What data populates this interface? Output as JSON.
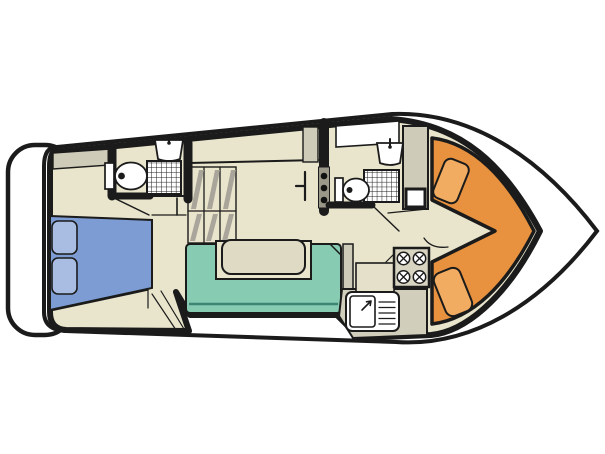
{
  "diagram": {
    "type": "boat-floor-plan",
    "description": "Top-down deck plan of a motor cruiser, bow to the right, stern with swim platform to the left",
    "orientation": {
      "bow": "right",
      "stern": "left"
    },
    "colors": {
      "background": "#ffffff",
      "outline": "#1b1b1b",
      "hull_white": "#ffffff",
      "floor": "#e9e5cc",
      "furniture_gray": "#cfcbb9",
      "counter_slab_gray": "#d2cebc",
      "worktop_light": "#e4e0c9",
      "stove_gray": "#d8d4c2",
      "stair_hatch_gray": "#a9a59b",
      "shelf_strip_gray": "#9b9789",
      "bed_blue": "#7c9cd3",
      "pillow_blue": "#a9bce2",
      "sofa_teal": "#86cbb2",
      "sofa_shadow_teal": "#3e8573",
      "table_beige": "#dedac4",
      "recess_beige": "#e9e5cc",
      "dinette_orange": "#e8923f",
      "cushion_orange": "#f1ac61",
      "fixture_white": "#ffffff",
      "window_white": "#ffffff"
    },
    "rooms": [
      {
        "name": "aft-cabin",
        "features": [
          "double-bed",
          "two-pillows",
          "dresser",
          "steps"
        ]
      },
      {
        "name": "aft-bathroom",
        "features": [
          "toilet",
          "washbasin",
          "shower-tray"
        ]
      },
      {
        "name": "companionway",
        "features": [
          "stairs-with-six-treads",
          "folding-door"
        ]
      },
      {
        "name": "saloon",
        "features": [
          "u-shaped-sofa",
          "table",
          "side-cabinet"
        ]
      },
      {
        "name": "forward-bathroom",
        "features": [
          "toilet",
          "washbasin",
          "shower-tray",
          "shelf-with-three-knobs",
          "wardrobe",
          "deck-hatch"
        ]
      },
      {
        "name": "galley",
        "features": [
          "four-burner-stove",
          "sink",
          "drainer",
          "worktop"
        ]
      },
      {
        "name": "bow-dinette",
        "features": [
          "v-shaped-bench",
          "two-seat-cushions",
          "walkway"
        ]
      }
    ],
    "exterior": [
      "swim-platform",
      "side-decks",
      "pointed-bow"
    ],
    "counts": {
      "burners": 4,
      "toilets": 2,
      "washbasins": 3,
      "showers": 2,
      "pillows": 2,
      "seat_cushions": 2,
      "stair_treads": 6
    }
  }
}
